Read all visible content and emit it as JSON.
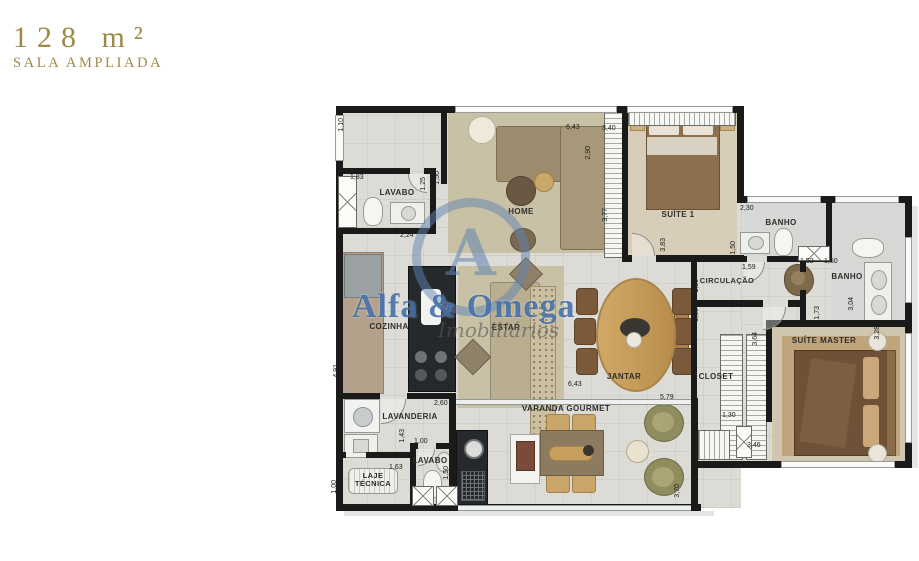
{
  "header": {
    "area": "128 m²",
    "subtitle": "SALA AMPLIADA"
  },
  "watermark": {
    "monogram": "A",
    "brand": "Alfa & Omega",
    "tagline": "Imobiliários",
    "brand_color": "#3f6fae"
  },
  "accent_color": "#9d8a45",
  "rooms": {
    "lavabo1": "LAVABO",
    "home": "HOME",
    "suite1": "SUÍTE 1",
    "banho1": "BANHO",
    "banho2": "BANHO",
    "circulacao": "CIRCULAÇÃO",
    "cozinha": "COZINHA",
    "estar": "ESTAR",
    "jantar": "JANTAR",
    "closet": "CLOSET",
    "suite_master": "SUÍTE MASTER",
    "lavanderia": "LAVANDERIA",
    "lavabo2": "LAVABO",
    "laje_tecnica": "LAJE TÉCNICA",
    "varanda": "VARANDA GOURMET"
  },
  "dimensions": [
    "1,10",
    "1,83",
    "1,25",
    "1,50",
    "2,24",
    "6,43",
    "2,90",
    "3,40",
    "3,77",
    "2,30",
    "1,50",
    "1,59",
    "3,83",
    "1,00",
    "3,60",
    "1,52",
    "1,50",
    "3,04",
    "1,73",
    "3,28",
    "3,64",
    "1,30",
    "3,46",
    "4,91",
    "2,60",
    "1,43",
    "1,00",
    "1,63",
    "1,00",
    "1,50",
    "6,43",
    "5,79",
    "3,70"
  ]
}
